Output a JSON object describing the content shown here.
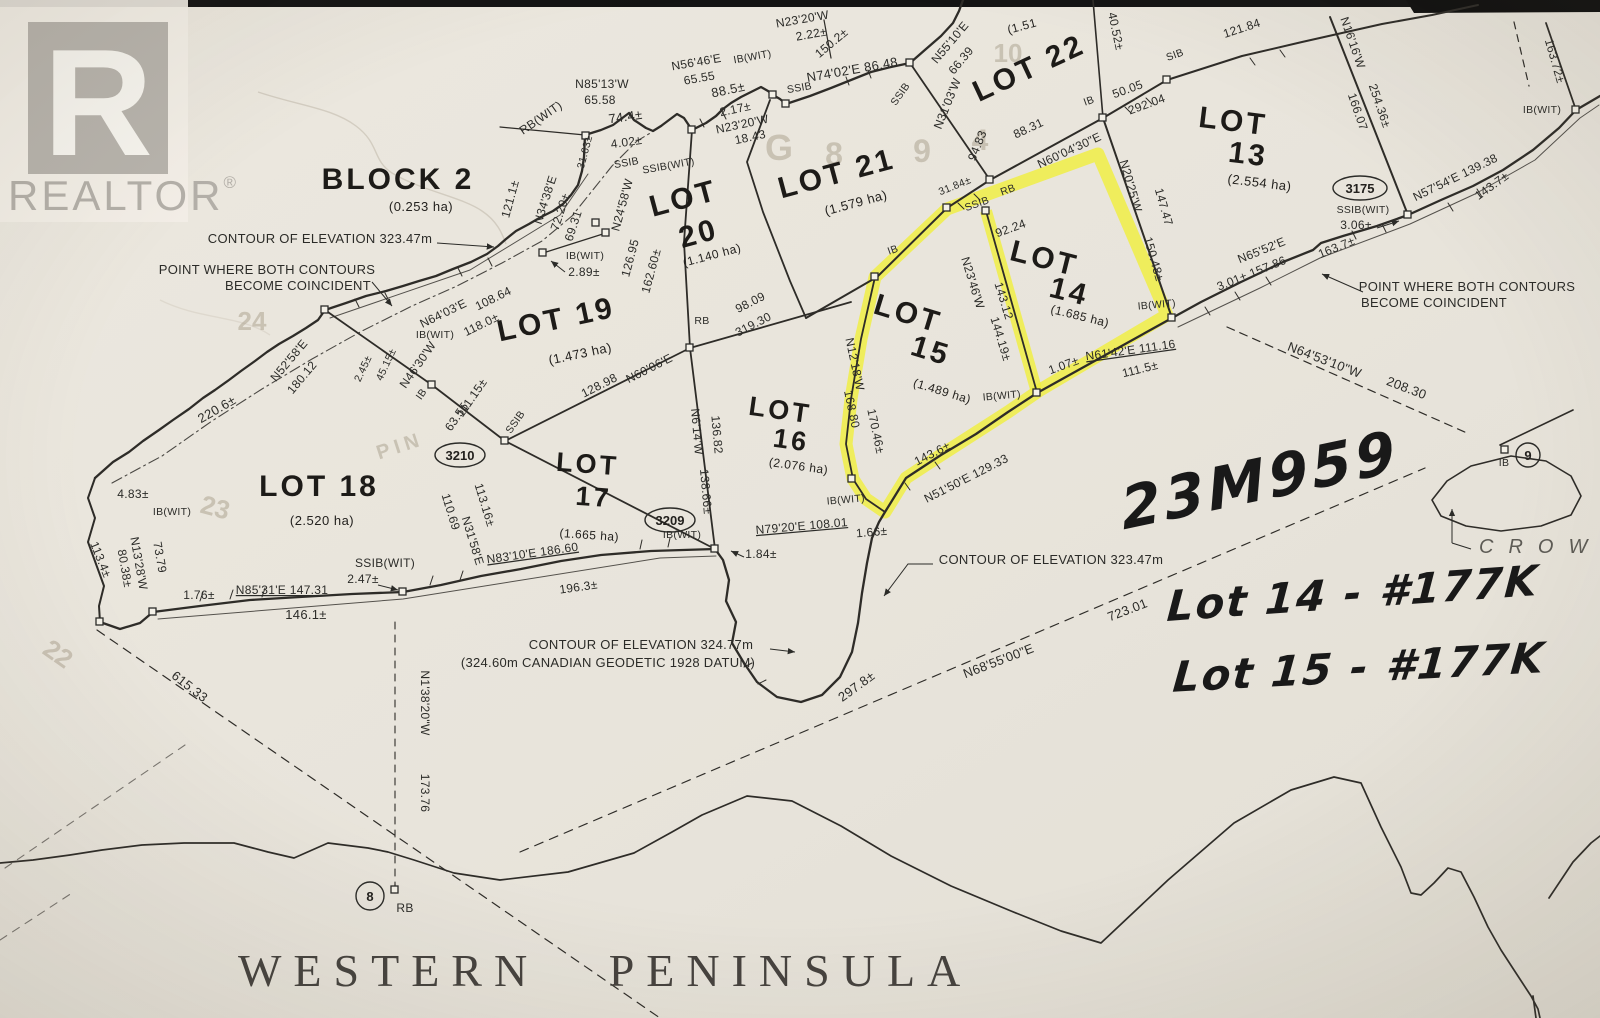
{
  "branding": {
    "logo_letter": "R",
    "brand": "REALTOR",
    "registered": "®"
  },
  "region_title": "WESTERN PENINSULA",
  "handwriting": {
    "plan_number": "23M959",
    "note_lot14": "Lot 14 - #177K",
    "note_lot15": "Lot 15 - #177K"
  },
  "colors": {
    "highlight": "#f0ef3c",
    "paper": "#e9e5dc",
    "ink": "#2b2b28",
    "logo_grey": "#b7b3ac"
  },
  "lots": [
    {
      "line1": "BLOCK 2",
      "line2": "",
      "area": "(0.253 ha)"
    },
    {
      "line1": "LOT",
      "line2": "13",
      "area": "(2.554 ha)"
    },
    {
      "line1": "LOT",
      "line2": "14",
      "area": "(1.685 ha)"
    },
    {
      "line1": "LOT",
      "line2": "15",
      "area": "(1.489 ha)"
    },
    {
      "line1": "LOT",
      "line2": "16",
      "area": "(2.076 ha)"
    },
    {
      "line1": "LOT",
      "line2": "17",
      "area": "(1.665 ha)"
    },
    {
      "line1": "LOT 18",
      "line2": "",
      "area": "(2.520 ha)"
    },
    {
      "line1": "LOT 19",
      "line2": "",
      "area": "(1.473 ha)"
    },
    {
      "line1": "LOT",
      "line2": "20",
      "area": "(1.140 ha)"
    },
    {
      "line1": "LOT 21",
      "line2": "",
      "area": "(1.579 ha)"
    },
    {
      "line1": "LOT 22",
      "line2": "",
      "area": "(1.51"
    }
  ],
  "monuments": {
    "m3210": "3210",
    "m3209": "3209",
    "m3175": "3175",
    "c8": "8",
    "c9": "9"
  },
  "ghost": {
    "g1": "G",
    "g2": "8",
    "g3": "9",
    "g4": "4",
    "g5": "10",
    "g6": "24",
    "g7": "23",
    "g8": "22",
    "g9": "PIN"
  },
  "labels": [
    {
      "t": "CONTOUR OF ELEVATION 323.47m"
    },
    {
      "t": "POINT WHERE BOTH CONTOURS"
    },
    {
      "t": "BECOME COINCIDENT"
    },
    {
      "t": "N85'13'W"
    },
    {
      "t": "65.58"
    },
    {
      "t": "RB(WIT)"
    },
    {
      "t": "74.4±"
    },
    {
      "t": "4.02±"
    },
    {
      "t": "121.1±"
    },
    {
      "t": "N34'38'E"
    },
    {
      "t": "72.20±"
    },
    {
      "t": "69.31"
    },
    {
      "t": "31.63±"
    },
    {
      "t": "SSIB"
    },
    {
      "t": "SSIB(WIT)"
    },
    {
      "t": "N24'58'W"
    },
    {
      "t": "126.95"
    },
    {
      "t": "162.60±"
    },
    {
      "t": "N56'46'E"
    },
    {
      "t": "65.55"
    },
    {
      "t": "IB(WIT)"
    },
    {
      "t": "88.5±"
    },
    {
      "t": "2.17±"
    },
    {
      "t": "N23'20'W"
    },
    {
      "t": "18.43"
    },
    {
      "t": "N23'20'W"
    },
    {
      "t": "2.22±"
    },
    {
      "t": "150.2±"
    },
    {
      "t": "SSIB"
    },
    {
      "t": "N74'02'E 86.48"
    },
    {
      "t": "SSIB"
    },
    {
      "t": "N31'03'W"
    },
    {
      "t": "94.83"
    },
    {
      "t": "N55'10'E"
    },
    {
      "t": "66.39"
    },
    {
      "t": "40.52±"
    },
    {
      "t": "SIB"
    },
    {
      "t": "121.84"
    },
    {
      "t": "IB"
    },
    {
      "t": "50.05"
    },
    {
      "t": "292.04"
    },
    {
      "t": "88.31"
    },
    {
      "t": "N60'04'30\"E"
    },
    {
      "t": "31.84±"
    },
    {
      "t": "SSIB"
    },
    {
      "t": "RB"
    },
    {
      "t": "N20'25'W"
    },
    {
      "t": "147.47"
    },
    {
      "t": "150.48±"
    },
    {
      "t": "N16'16'W"
    },
    {
      "t": "166.07"
    },
    {
      "t": "254.36±"
    },
    {
      "t": "163.72±"
    },
    {
      "t": "IB(WIT)"
    },
    {
      "t": "N57'54'E 139.38"
    },
    {
      "t": "143.7±"
    },
    {
      "t": "163.7±"
    },
    {
      "t": "N65'52'E"
    },
    {
      "t": "3.01± 157.86"
    },
    {
      "t": "POINT WHERE BOTH CONTOURS"
    },
    {
      "t": "BECOME COINCIDENT"
    },
    {
      "t": "N64'53'10\"W"
    },
    {
      "t": "208.30"
    },
    {
      "t": "SSIB(WIT)"
    },
    {
      "t": "3.06±"
    },
    {
      "t": "IB"
    },
    {
      "t": "N64'03'E"
    },
    {
      "t": "108.64"
    },
    {
      "t": "118.0±"
    },
    {
      "t": "IB(WIT)"
    },
    {
      "t": "IB(WIT)"
    },
    {
      "t": "2.89±"
    },
    {
      "t": "N52'58'E"
    },
    {
      "t": "180.12"
    },
    {
      "t": "2.45±"
    },
    {
      "t": "45.15±"
    },
    {
      "t": "N46'30'W"
    },
    {
      "t": "111.15±"
    },
    {
      "t": "IB"
    },
    {
      "t": "63.55"
    },
    {
      "t": "SSIB"
    },
    {
      "t": "128.98"
    },
    {
      "t": "N60'06'E"
    },
    {
      "t": "RB"
    },
    {
      "t": "98.09"
    },
    {
      "t": "319.30"
    },
    {
      "t": "N6'14'W"
    },
    {
      "t": "136.82"
    },
    {
      "t": "138.66±"
    },
    {
      "t": "110.69"
    },
    {
      "t": "113.16±"
    },
    {
      "t": "N31'58'E"
    },
    {
      "t": "N83'10'E 186.60"
    },
    {
      "t": "196.3±"
    },
    {
      "t": "IB(WIT)"
    },
    {
      "t": "1.84±"
    },
    {
      "t": "N79'20'E 108.01"
    },
    {
      "t": "1.66±"
    },
    {
      "t": "IB(WIT)"
    },
    {
      "t": "N12'18'W"
    },
    {
      "t": "170.46±"
    },
    {
      "t": "168.80"
    },
    {
      "t": "IB"
    },
    {
      "t": "92.24"
    },
    {
      "t": "N23'46'W"
    },
    {
      "t": "143.12"
    },
    {
      "t": "144.19±"
    },
    {
      "t": "IB(WIT)"
    },
    {
      "t": "1.07±"
    },
    {
      "t": "N61'42'E 111.16"
    },
    {
      "t": "111.5±"
    },
    {
      "t": "IB(WIT)"
    },
    {
      "t": "143.6±"
    },
    {
      "t": "N51'50'E 129.33"
    },
    {
      "t": "113.4±"
    },
    {
      "t": "80.38±"
    },
    {
      "t": "N13'28'W"
    },
    {
      "t": "73.79"
    },
    {
      "t": "4.83±"
    },
    {
      "t": "IB(WIT)"
    },
    {
      "t": "220.6±"
    },
    {
      "t": "1.76±"
    },
    {
      "t": "N85'31'E 147.31"
    },
    {
      "t": "146.1±"
    },
    {
      "t": "SSIB(WIT)"
    },
    {
      "t": "2.47±"
    },
    {
      "t": "615.33"
    },
    {
      "t": "N1'38'20\"W"
    },
    {
      "t": "173.76"
    },
    {
      "t": "RB"
    },
    {
      "t": "N68'55'00\"E"
    },
    {
      "t": "723.01"
    },
    {
      "t": "297.8±"
    },
    {
      "t": "CONTOUR OF ELEVATION 324.77m"
    },
    {
      "t": "(324.60m CANADIAN GEODETIC 1928 DATUM)"
    },
    {
      "t": "CONTOUR OF ELEVATION 323.47m"
    },
    {
      "t": "CROW"
    }
  ]
}
